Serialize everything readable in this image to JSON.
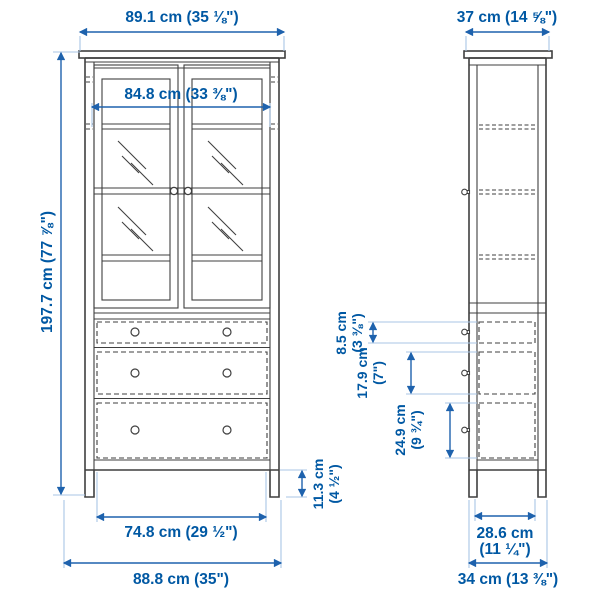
{
  "document": {
    "kind": "furniture dimension diagram",
    "product": "glass-door cabinet with 3 drawers",
    "views": [
      "front",
      "side"
    ]
  },
  "colors": {
    "background": "#ffffff",
    "dimension_text": "#0058a3",
    "dimension_line": "#1e62ad",
    "extension_line": "#a8c5e5",
    "furniture_line": "#3f3f3f"
  },
  "dimensions": {
    "front_top_width": "89.1 cm (35 ⅛\")",
    "front_inner_width": "84.8 cm (33 ⅜\")",
    "front_height": "197.7 cm (77 ⅞\")",
    "plinth_height_cm": "11.3 cm",
    "plinth_height_in": "(4 ½\")",
    "front_inner_bottom_width": "74.8 cm (29 ½\")",
    "front_bottom_width": "88.8 cm (35\")",
    "side_top_depth": "37 cm (14 ⅝\")",
    "drawer1_height_cm": "8.5 cm",
    "drawer1_height_in": "(3 ⅜\")",
    "drawer2_height_cm": "17.9 cm",
    "drawer2_height_in": "(7\")",
    "drawer3_height_cm": "24.9 cm",
    "drawer3_height_in": "(9 ¾\")",
    "side_inner_bottom_depth_cm": "28.6 cm",
    "side_inner_bottom_depth_in": "(11 ¼\")",
    "side_bottom_depth": "34 cm (13 ⅜\")"
  }
}
